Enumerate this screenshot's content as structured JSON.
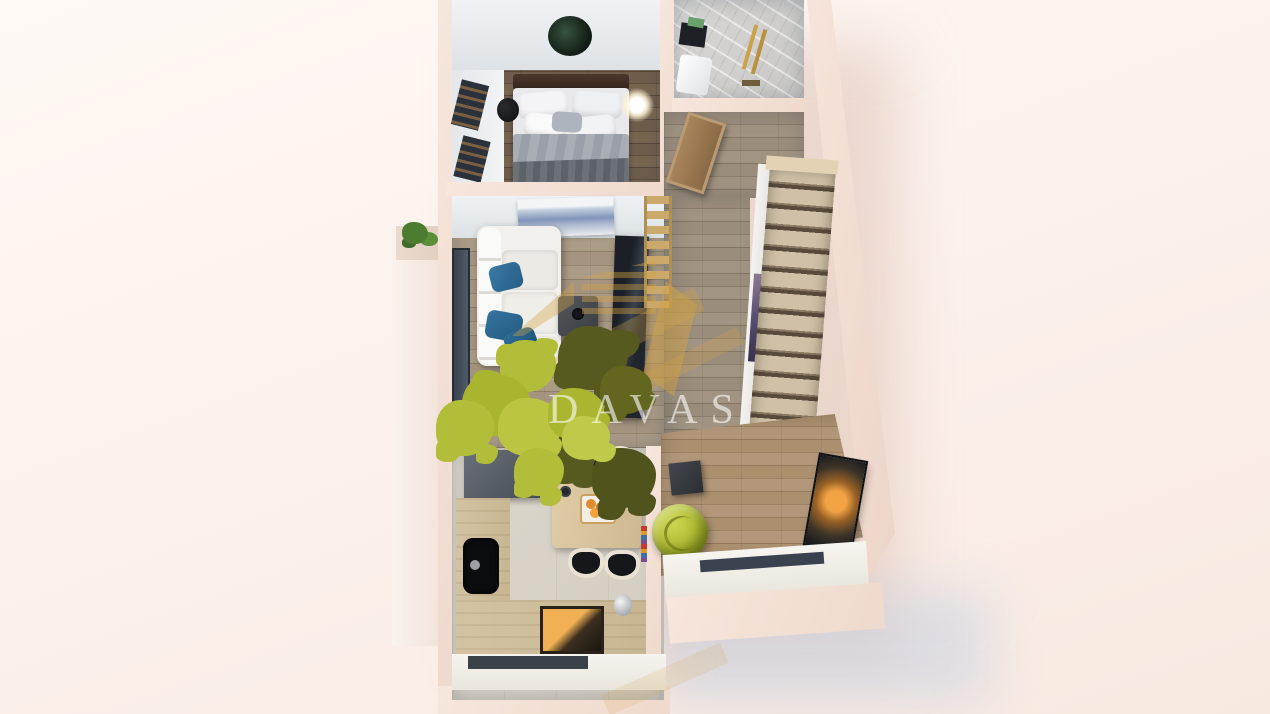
{
  "watermark": {
    "text": "DAVAS",
    "text_color": "rgba(255,255,255,0.60)",
    "gold_color": "#d2a245",
    "leaf_dark_color": "#575a1f",
    "leaf_light_color": "#b2bd39",
    "logo_parts": [
      "gold-buildings-icon",
      "puzzle-tree-icon",
      "wordmark"
    ]
  },
  "scene": {
    "type": "3d-floor-plan-top-view-render",
    "background_color": "#fcf2ec",
    "exterior_wall_color": "#f2ddd2",
    "interior_wall_color": "#eef1f3",
    "rooms": [
      {
        "name": "bedroom",
        "floor_color": "#6e5c4b",
        "items": [
          "double-bed",
          "dark-headboard",
          "white-pillows",
          "gray-duvet",
          "round-wall-art",
          "nightstand-stool",
          "glowing-floor-lamp",
          "slatted-windows"
        ]
      },
      {
        "name": "bathroom",
        "floor_color": "#d4d3d1",
        "items": [
          "marble-tiling",
          "brass-shower-set",
          "vanity-sink",
          "dark-mirror",
          "green-towel"
        ]
      },
      {
        "name": "entry-hall",
        "floor_color": "#98897a",
        "items": [
          "wooden-entry-door"
        ]
      },
      {
        "name": "staircase",
        "floor_color": "#c9bba1",
        "items": [
          "wooden-steps",
          "stairwell-artwork"
        ]
      },
      {
        "name": "living-room",
        "floor_color": "#a2947f",
        "items": [
          "l-shaped-white-sofa",
          "teal-pillows",
          "mountain-artwork",
          "coffee-table",
          "dark-tv-unit",
          "ladder-shelf",
          "window-wall"
        ]
      },
      {
        "name": "kitchen-dining",
        "floor_color": "#d8d3c8",
        "items": [
          "cooker-hood",
          "left-counter",
          "black-sink",
          "oven-with-glow",
          "kettle",
          "dining-table",
          "four-chairs",
          "fruit-bowl",
          "divider-wall",
          "book-strip"
        ]
      },
      {
        "name": "lounge-corner",
        "floor_color": "#a78c6b",
        "items": [
          "green-pouf-armchair",
          "dark-side-table",
          "wall-tv-sunset",
          "window-sill"
        ]
      },
      {
        "name": "balcony",
        "floor_color": "#f7efe8",
        "items": [
          "glass-balustrade",
          "planter-with-plants"
        ]
      }
    ]
  }
}
